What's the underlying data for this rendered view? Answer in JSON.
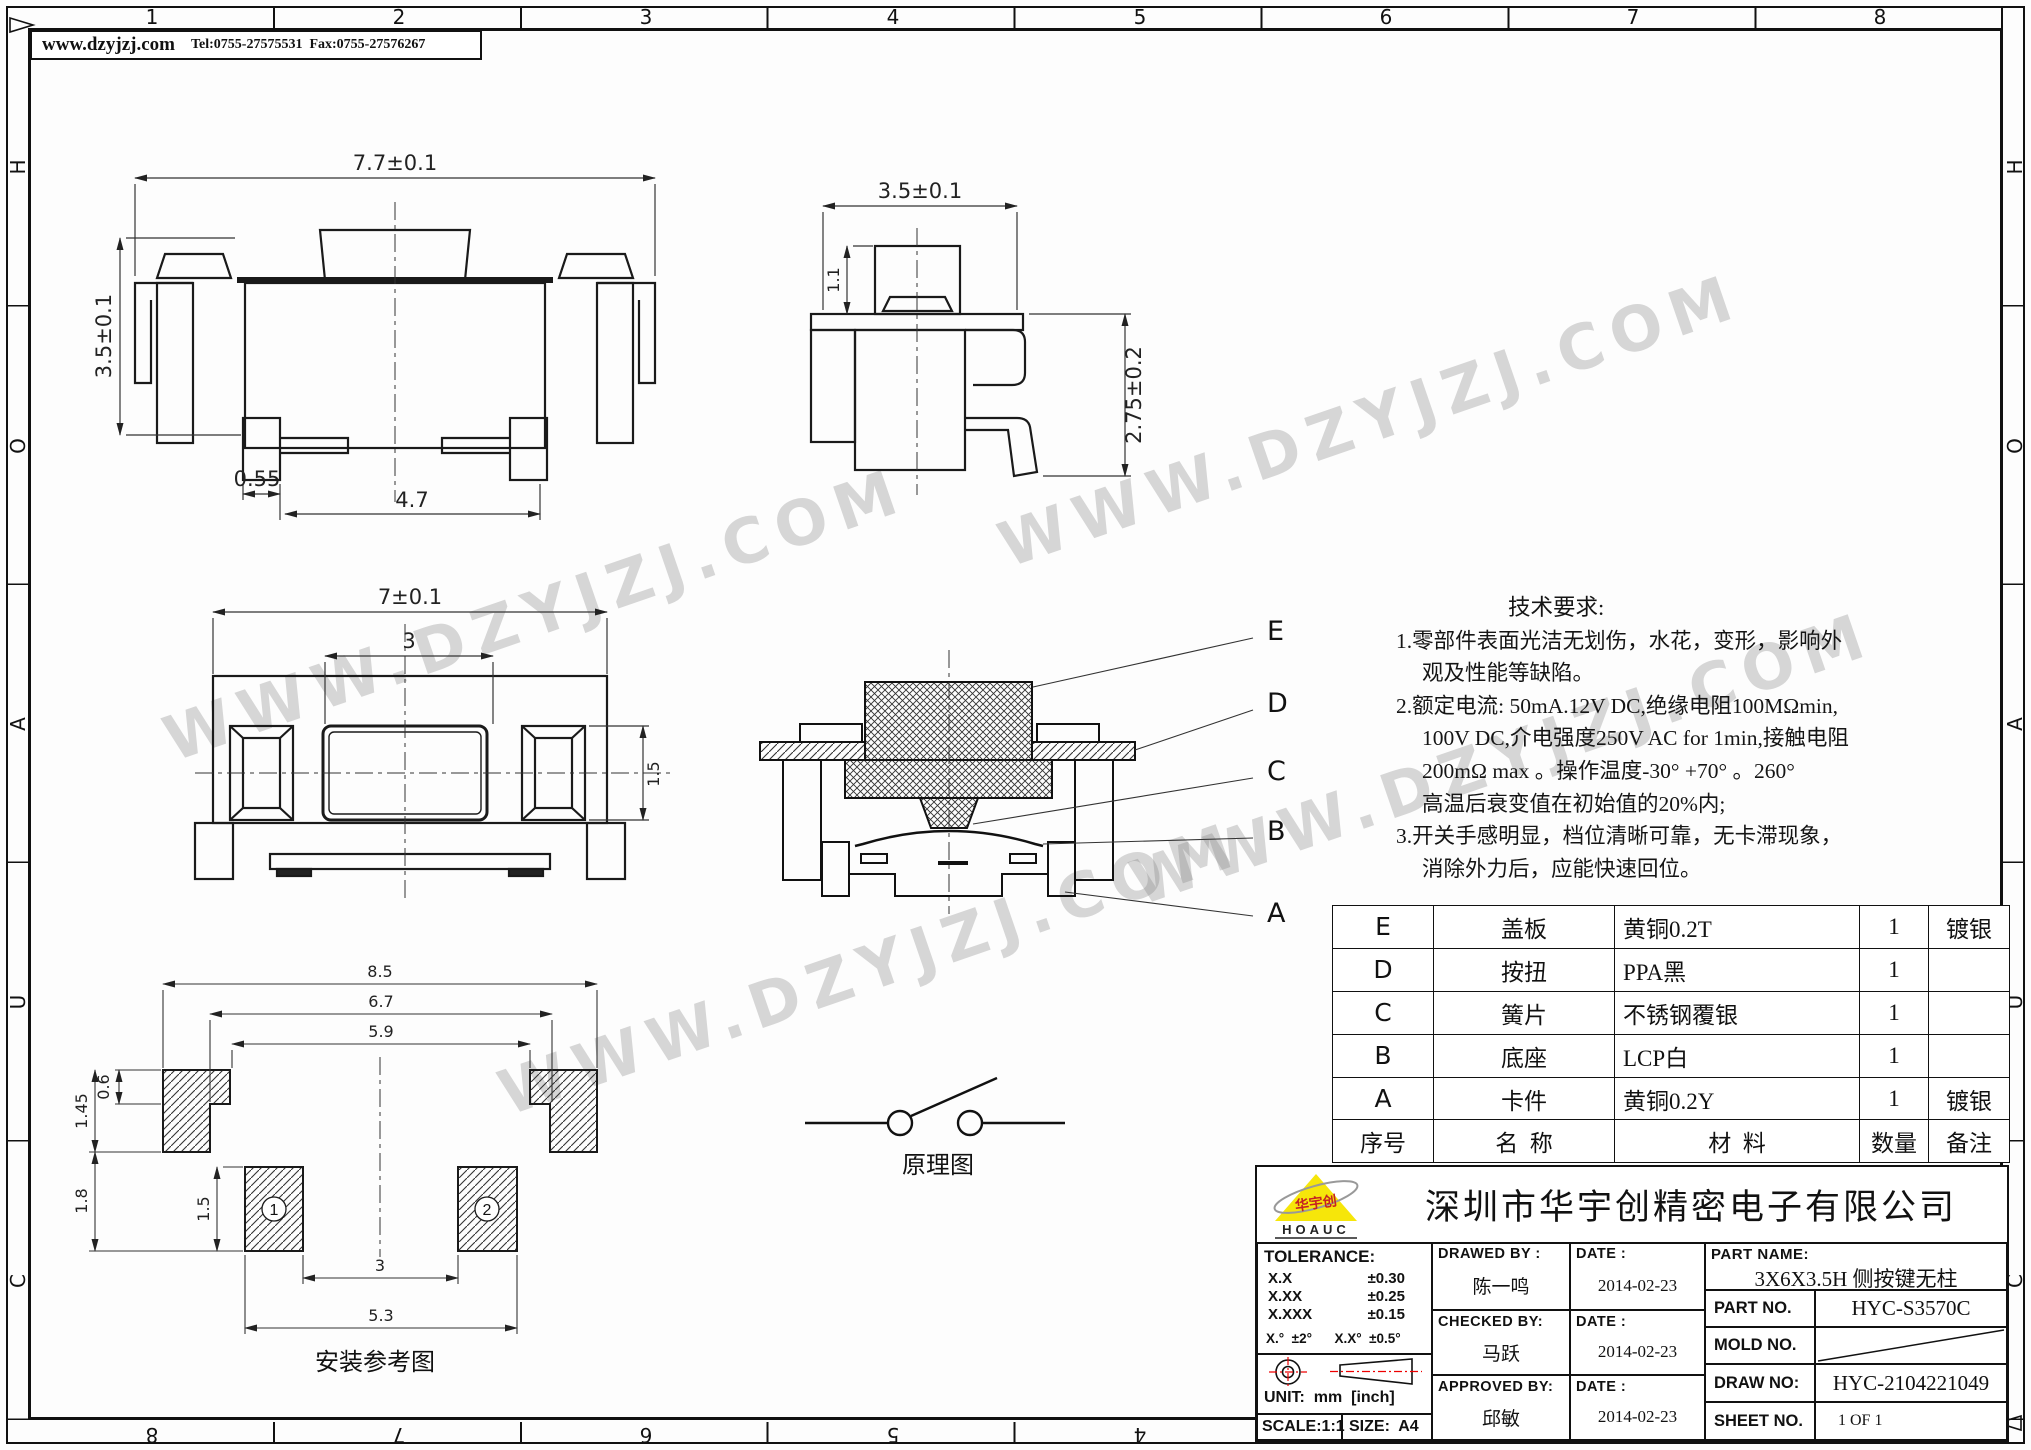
{
  "header": {
    "website": "www.dzyjzj.com",
    "contact": "Tel:0755-27575531  Fax:0755-27576267"
  },
  "border": {
    "top_zones": [
      "1",
      "2",
      "3",
      "4",
      "5",
      "6",
      "7",
      "8"
    ],
    "bottom_zones": [
      "8",
      "7",
      "6",
      "5",
      "4",
      "3",
      "2",
      "1"
    ],
    "left_zones": [
      "H",
      "O",
      "A",
      "U",
      "C"
    ],
    "right_zones": [
      "H",
      "O",
      "A",
      "U",
      "C"
    ]
  },
  "watermark": {
    "text": "WWW.DZYJZJ.COM"
  },
  "views": {
    "front": {
      "dim_width": "7.7±0.1",
      "dim_height": "3.5±0.1",
      "dim_foot": "0.55",
      "dim_span": "4.7"
    },
    "side": {
      "dim_width": "3.5±0.1",
      "dim_button": "1.1",
      "dim_height": "2.75±0.2"
    },
    "top": {
      "dim_width": "7±0.1",
      "dim_button": "3",
      "dim_slot": "1.5"
    },
    "section": {
      "label_e": "E",
      "label_d": "D",
      "label_c": "C",
      "label_b": "B",
      "label_a": "A"
    },
    "install": {
      "dim_overall": "8.5",
      "dim_mid": "6.7",
      "dim_inner": "5.9",
      "dim_top_pad": "0.6",
      "dim_pad_total": "1.45",
      "dim_lower": "1.8",
      "dim_pad_h": "1.5",
      "dim_gap": "3",
      "dim_span": "5.3",
      "pad1": "1",
      "pad2": "2",
      "caption": "安装参考图"
    },
    "schematic": {
      "caption": "原理图"
    }
  },
  "tech": {
    "title": "技术要求:",
    "l1": "1.零部件表面光洁无划伤，水花，变形，影响外",
    "l2": "观及性能等缺陷。",
    "l3": "2.额定电流: 50mA.12V DC,绝缘电阻100MΩmin,",
    "l4": "100V DC,介电强度250V AC for 1min,接触电阻",
    "l5": "200mΩ max 。操作温度-30° +70° 。260°",
    "l6": "高温后衰变值在初始值的20%内;",
    "l7": "3.开关手感明显，档位清晰可靠，无卡滞现象，",
    "l8": "消除外力后，应能快速回位。"
  },
  "bom": {
    "headers": [
      "序号",
      "名  称",
      "材  料",
      "数量",
      "备注"
    ],
    "rows": [
      [
        "E",
        "盖板",
        "黄铜0.2T",
        "1",
        "镀银"
      ],
      [
        "D",
        "按扭",
        "PPA黑",
        "1",
        ""
      ],
      [
        "C",
        "簧片",
        "不锈钢覆银",
        "1",
        ""
      ],
      [
        "B",
        "底座",
        "LCP白",
        "1",
        ""
      ],
      [
        "A",
        "卡件",
        "黄铜0.2Y",
        "1",
        "镀银"
      ]
    ]
  },
  "title_block": {
    "company": "深圳市华宇创精密电子有限公司",
    "logo_brand": "HOAUC",
    "logo_text": "华宇创",
    "tolerance_label": "TOLERANCE:",
    "tol1_l": "X.X",
    "tol1_v": "±0.30",
    "tol2_l": "X.XX",
    "tol2_v": "±0.25",
    "tol3_l": "X.XXX",
    "tol3_v": "±0.15",
    "tol_ang": "X.°  ±2°      X.X°  ±0.5°",
    "unit": "UNIT:  mm  [inch]",
    "scale": "SCALE:1:1",
    "size": "SIZE:  A4",
    "drawed_label": "DRAWED  BY :",
    "drawed_name": "陈一鸣",
    "checked_label": "CHECKED  BY:",
    "checked_name": "马跃",
    "approved_label": "APPROVED  BY:",
    "approved_name": "邱敏",
    "date_label": "DATE :",
    "date1": "2014-02-23",
    "date2": "2014-02-23",
    "date3": "2014-02-23",
    "part_name_label": "PART  NAME:",
    "part_name": "3X6X3.5H 侧按键无柱",
    "part_no_label": "PART  NO.",
    "part_no": "HYC-S3570C",
    "mold_no_label": "MOLD  NO.",
    "draw_no_label": "DRAW  NO:",
    "draw_no": "HYC-2104221049",
    "sheet_no_label": "SHEET  NO.",
    "sheet_no": "1 OF 1"
  }
}
